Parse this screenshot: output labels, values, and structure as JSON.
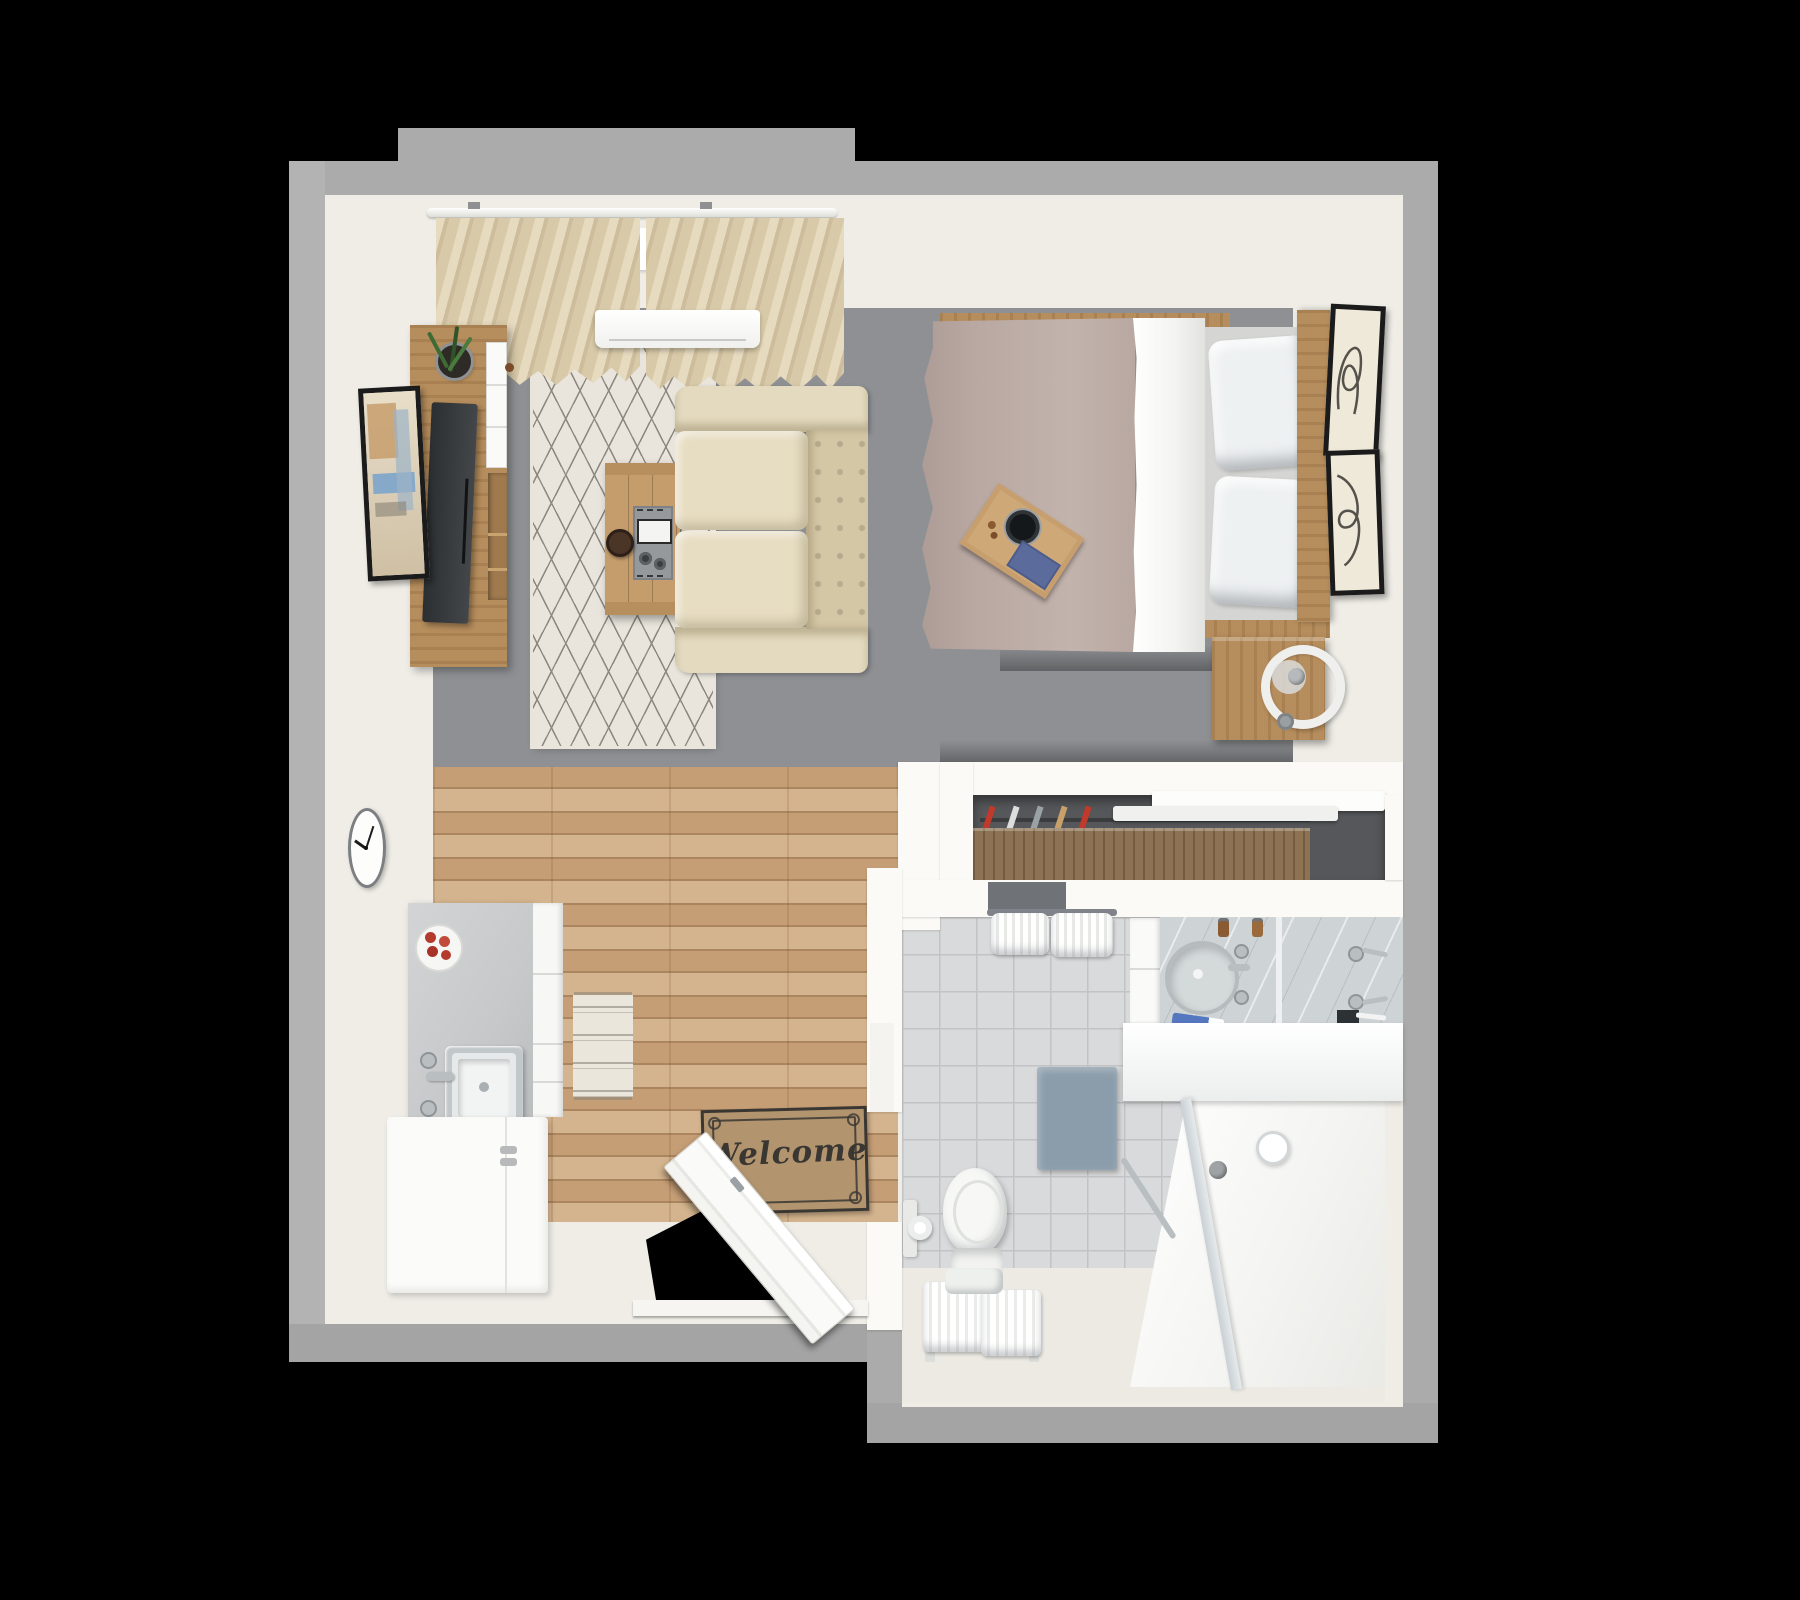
{
  "scene": {
    "kind": "3d-floor-plan-top-view",
    "rooms": [
      "living-bedroom",
      "kitchen",
      "entry-hall",
      "bathroom",
      "closet"
    ]
  },
  "entry_mat": {
    "text": "Welcome"
  },
  "clock": {
    "time": "10:10"
  },
  "counts": {
    "bed_pillows": 2,
    "right_wall_frames": 2,
    "sofa_cushions": 2,
    "closet_hangers": 5,
    "bath_towels": 2
  },
  "colors": {
    "bg": "#000000",
    "outer_wall": "#ababab",
    "inner_floor": "#efede6",
    "inner_wall": "#fbfaf7",
    "living_floor": "#8e9093",
    "wood_a": "#c69e76",
    "wood_b": "#ab855f",
    "wood_c": "#d4b48e",
    "wood_furniture": "#b68d5c",
    "wood_dark": "#8d7354",
    "closet_back": "#55575a",
    "tile": "#d9dadb",
    "tile_grout": "#c2c3c5",
    "shower_floor": "#f4f5f2",
    "glass": "#c9cfd4",
    "rug": "#e9e5dc",
    "rug_line": "#8d8880",
    "runner_rug": "#eae6dc",
    "sofa": "#e4dabf",
    "sofa_dark": "#d4c7a6",
    "duvet": "#b9a8a2",
    "sheet": "#f3f3f1",
    "mattress": "#d5d6d4",
    "pillow": "#eef1f2",
    "counter_gray": "#c6c8c9",
    "white_goods": "#fbfbf9",
    "marble": "#ced3d6",
    "chrome": "#b9bec1",
    "mat_brown": "#b2946f",
    "mat_ink": "#3a3733",
    "curtain_a": "#e6dabf",
    "curtain_b": "#d8caa8",
    "curtain_c": "#cdbd9c",
    "blue_mat": "#8b9dab",
    "blue_item": "#5b6b9c",
    "towel_white": "#f6f7f5",
    "frame_black": "#1b1b1b",
    "art_paper": "#efe9d9",
    "plant_green": "#3e6b34",
    "knob_red": "#b43a2e"
  }
}
